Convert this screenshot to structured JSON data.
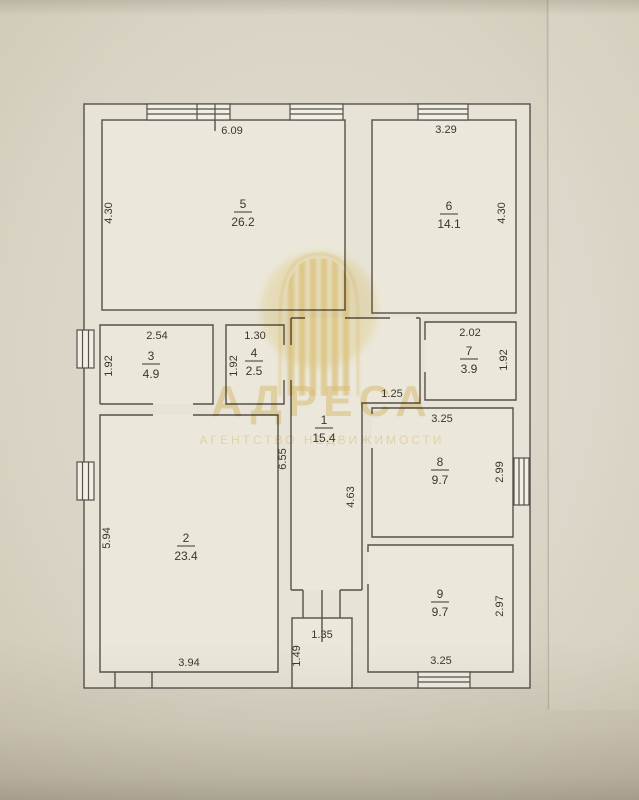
{
  "watermark": {
    "brand": "АДРЕСА",
    "tagline": "АГЕНТСТВО НЕДВИЖИМОСТИ"
  },
  "plan": {
    "room1": {
      "number": "1",
      "area": "15.4",
      "dim_left": "6.55",
      "dim_right": "4.63",
      "dim_step": "1.25"
    },
    "room2": {
      "number": "2",
      "area": "23.4",
      "dim_left": "5.94",
      "dim_bottom": "3.94"
    },
    "room3": {
      "number": "3",
      "area": "4.9",
      "dim_top": "2.54",
      "dim_left": "1.92"
    },
    "room4": {
      "number": "4",
      "area": "2.5",
      "dim_top": "1.30",
      "dim_left": "1.92"
    },
    "room5": {
      "number": "5",
      "area": "26.2",
      "dim_top": "6.09",
      "dim_left": "4.30"
    },
    "room6": {
      "number": "6",
      "area": "14.1",
      "dim_top": "3.29",
      "dim_right": "4.30"
    },
    "room7": {
      "number": "7",
      "area": "3.9",
      "dim_top": "2.02",
      "dim_right": "1.92"
    },
    "room8": {
      "number": "8",
      "area": "9.7",
      "dim_top": "3.25",
      "dim_right": "2.99"
    },
    "room9": {
      "number": "9",
      "area": "9.7",
      "dim_bottom": "3.25",
      "dim_right": "2.97"
    },
    "vestibule": {
      "dim_top": "1.35",
      "dim_left": "1.49"
    }
  },
  "colors": {
    "watermark_gold": "#e9cf86",
    "line": "#55504a",
    "paper": "#e8e4d8",
    "background": "#d8d2c3"
  }
}
